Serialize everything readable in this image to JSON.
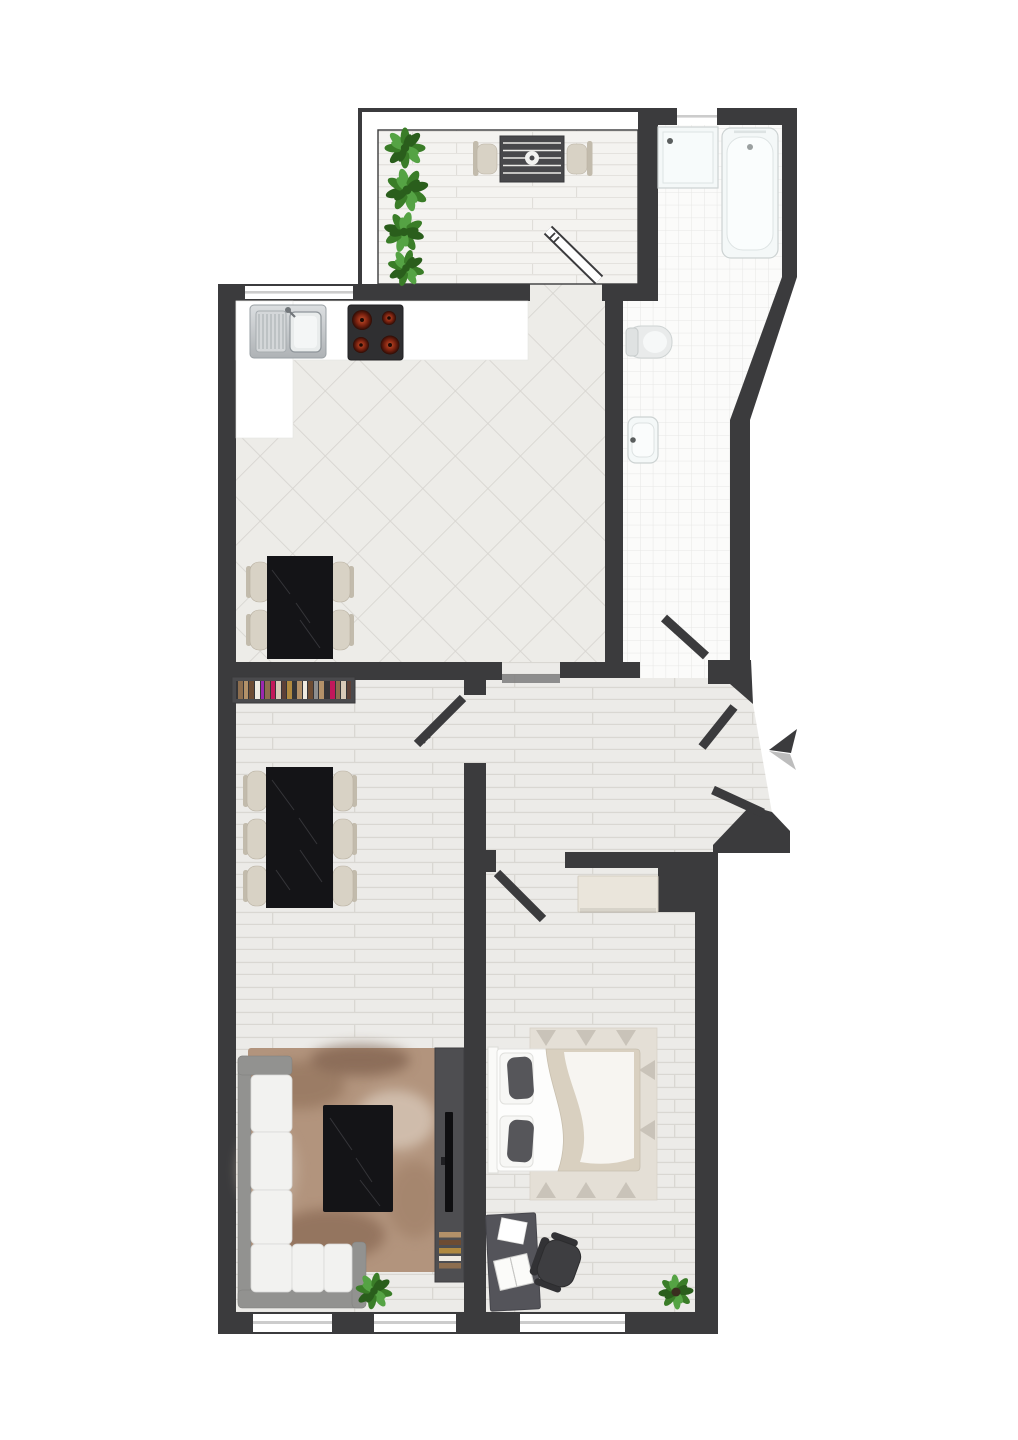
{
  "title": "Two-room apartment floor plan, top view",
  "canvas": {
    "width": 1018,
    "height": 1440
  },
  "colors": {
    "wall": "#3b3b3d",
    "floor_plank": "#ecebe8",
    "floor_line": "#d9d7d2",
    "deck": "#f4f3f0",
    "deck_line": "#e0ded9",
    "tile": "#edece8",
    "tile_line": "#d7d5d0",
    "bath_floor": "#fbfbfa",
    "bath_grid": "#e7e7e5",
    "counter": "#ffffff",
    "marble": "#141417",
    "marble_vein": "#8d8d92",
    "chair": "#d8d2c5",
    "chair_dark": "#c2bbac",
    "steel": "#c6c9cc",
    "steel_dark": "#8a8d90",
    "stove": "#2f2f31",
    "burner": "#a23317",
    "shelf": "#4a4a4d",
    "sofa_frame": "#929290",
    "cushion": "#f2f2f0",
    "rug_living": "#b2947d",
    "rug_bedroom": "#e4dfd6",
    "tv_unit": "#4e4e51",
    "tv": "#0f0f11",
    "wardrobe": "#eae5db",
    "desk": "#54545a",
    "office_chair": "#3e3e41",
    "bed_white": "#fdfdfc",
    "blanket": "#d9d0c0",
    "pillow": "#56565a",
    "plant": "#3a7d28",
    "plant_light": "#55a344",
    "plant_dark": "#2a5e1c",
    "fixture": "#f4f8f8",
    "fixture_line": "#ccd2d2",
    "threshold": "#7d7d7d",
    "window_glass": "#cccccc",
    "arrow": "#3b3b3d",
    "arrow_shadow": "#bdbdbd",
    "door": "#3b3b3d",
    "door_glass": "#ffffff"
  },
  "books": [
    "#8d6e4f",
    "#b39169",
    "#6d4c33",
    "#efeae0",
    "#9c27b0",
    "#c2185b",
    "#d7c9b8",
    "#5d4037",
    "#b0893f",
    "#8e8e8e"
  ],
  "rooms": [
    {
      "id": "balcony",
      "name": "Balcony",
      "furniture": [
        "planter-row",
        "bistro-table",
        "two-chairs",
        "glass-door"
      ]
    },
    {
      "id": "bathroom",
      "name": "Bathroom",
      "furniture": [
        "shower",
        "bathtub",
        "toilet",
        "wash-basin",
        "window",
        "door"
      ]
    },
    {
      "id": "kitchen",
      "name": "Kitchen",
      "furniture": [
        "sink-unit",
        "cooktop",
        "counter",
        "table-for-four",
        "window"
      ]
    },
    {
      "id": "living-dining",
      "name": "Living / Dining Room",
      "furniture": [
        "bookshelf",
        "dining-table-six-chairs",
        "corner-sofa",
        "area-rug",
        "coffee-table",
        "tv-unit",
        "potted-plant",
        "two-windows"
      ]
    },
    {
      "id": "hallway",
      "name": "Hallway",
      "furniture": [
        "entrance-double-door",
        "entrance-arrow",
        "interior-doors"
      ]
    },
    {
      "id": "bedroom",
      "name": "Bedroom",
      "furniture": [
        "wardrobe",
        "double-bed",
        "rug",
        "desk",
        "office-chair",
        "potted-plant",
        "window"
      ]
    }
  ]
}
